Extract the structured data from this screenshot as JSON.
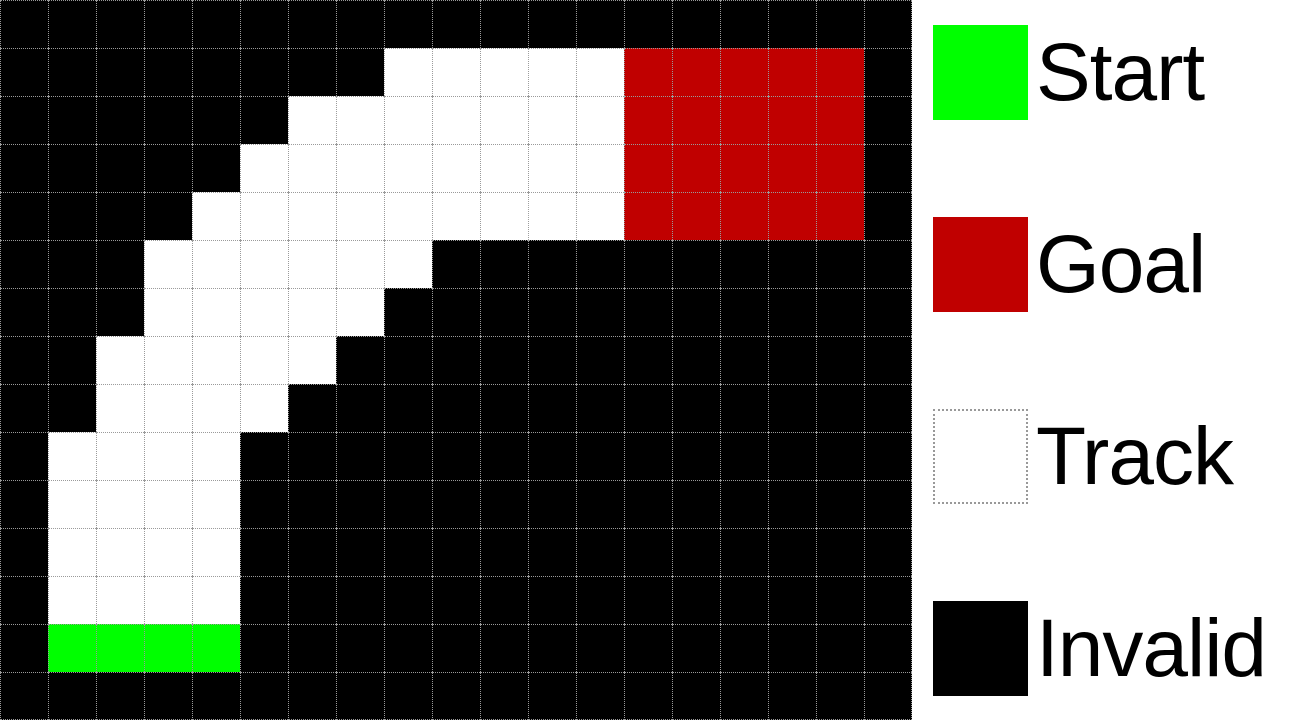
{
  "figure": {
    "description": "Racetrack grid-world map with legend"
  },
  "grid": {
    "cols": 19,
    "rows": 15,
    "cell_size_px": 48,
    "grid_line_color": "#9a9a9a",
    "palette": {
      "K": {
        "name": "invalid-cell",
        "color": "#000000",
        "label": "Invalid"
      },
      "W": {
        "name": "track-cell",
        "color": "#ffffff",
        "label": "Track"
      },
      "R": {
        "name": "goal-cell",
        "color": "#c00000",
        "label": "Goal"
      },
      "G": {
        "name": "start-cell",
        "color": "#00ff00",
        "label": "Start"
      }
    },
    "map": [
      "KKKKKKKKKKKKKKKKKKK",
      "KKKKKKKKWWWWWRRRRRK",
      "KKKKKKWWWWWWWRRRRRK",
      "KKKKKWWWWWWWWRRRRRK",
      "KKKKWWWWWWWWWRRRRRK",
      "KKKWWWWWWKKKKKKKKKK",
      "KKKWWWWWKKKKKKKKKKK",
      "KKWWWWWKKKKKKKKKKKK",
      "KKWWWWKKKKKKKKKKKKK",
      "KWWWWKKKKKKKKKKKKKK",
      "KWWWWKKKKKKKKKKKKKK",
      "KWWWWKKKKKKKKKKKKKK",
      "KWWWWKKKKKKKKKKKKKK",
      "KGGGGKKKKKKKKKKKKKK",
      "KKKKKKKKKKKKKKKKKKK"
    ]
  },
  "legend": {
    "items": [
      {
        "label": "Start",
        "color": "#00ff00"
      },
      {
        "label": "Goal",
        "color": "#c00000"
      },
      {
        "label": "Track",
        "color": "#ffffff"
      },
      {
        "label": "Invalid",
        "color": "#000000"
      }
    ]
  }
}
